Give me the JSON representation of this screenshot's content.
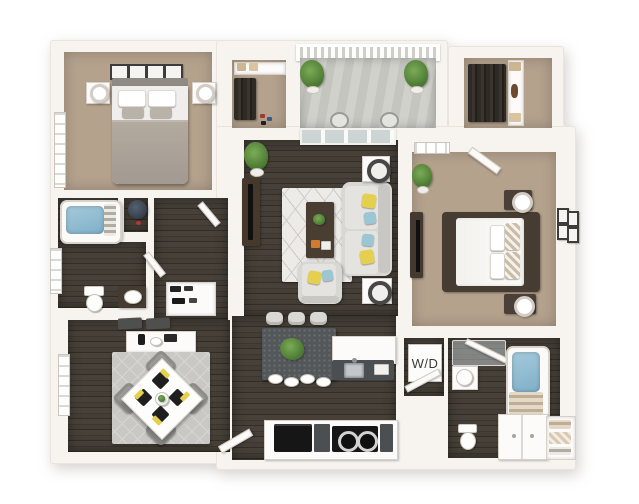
{
  "scene": {
    "description": "3D rendered apartment floor plan viewed from above",
    "background": "#ffffff"
  },
  "labels": {
    "washer_dryer": "W/D"
  },
  "palette": {
    "wall": "#f7f4f0",
    "wall_edge": "#d9d3cb",
    "carpet_tan": "#b4a28d",
    "hardwood_dark": "#443e37",
    "balcony_concrete": "#cbccc6",
    "rug_living": "#edebe7",
    "rug_dining": "#c9c8c5",
    "sofa_gray": "#d8d7d3",
    "accent_yellow": "#e5cf4e",
    "accent_blue": "#9cc6d4",
    "plant_green": "#55823c",
    "island_gray": "#54575a",
    "appliance_black": "#181818",
    "bath_water_blue": "#8cb8cf",
    "furniture_brown": "#473c32",
    "label_text": "#3a3a3a"
  },
  "rooms": [
    {
      "name": "bedroom-1",
      "floor": "carpet"
    },
    {
      "name": "closet-1",
      "floor": "carpet"
    },
    {
      "name": "balcony",
      "floor": "concrete"
    },
    {
      "name": "walk-in-closet",
      "floor": "carpet"
    },
    {
      "name": "living-room",
      "floor": "hardwood"
    },
    {
      "name": "master-bedroom",
      "floor": "carpet"
    },
    {
      "name": "bathroom-1",
      "floor": "hardwood"
    },
    {
      "name": "water-heater-closet",
      "floor": "hardwood"
    },
    {
      "name": "hallway-entry",
      "floor": "hardwood"
    },
    {
      "name": "linen-closet",
      "floor": "hardwood"
    },
    {
      "name": "dining-area",
      "floor": "hardwood"
    },
    {
      "name": "kitchen",
      "floor": "hardwood"
    },
    {
      "name": "laundry-closet",
      "floor": "hardwood",
      "label": "W/D"
    },
    {
      "name": "master-bathroom",
      "floor": "hardwood"
    },
    {
      "name": "towel-closet",
      "floor": "hardwood"
    }
  ],
  "furniture": [
    "queen-bed-gray",
    "nightstands-with-lamps",
    "wall-art-frames",
    "hanging-clothes",
    "storage-boxes",
    "balcony-plants",
    "balcony-chairs",
    "sofa-with-pillows",
    "armchair",
    "coffee-table",
    "tv-console",
    "area-rugs",
    "dining-table-set",
    "sideboard",
    "kitchen-island-with-stools",
    "sink-counter",
    "cooktop",
    "oven",
    "bathtubs-with-water",
    "toilets",
    "vanities",
    "washer-dryer-stack",
    "towel-shelves",
    "water-heater-tank",
    "potted-plants"
  ]
}
